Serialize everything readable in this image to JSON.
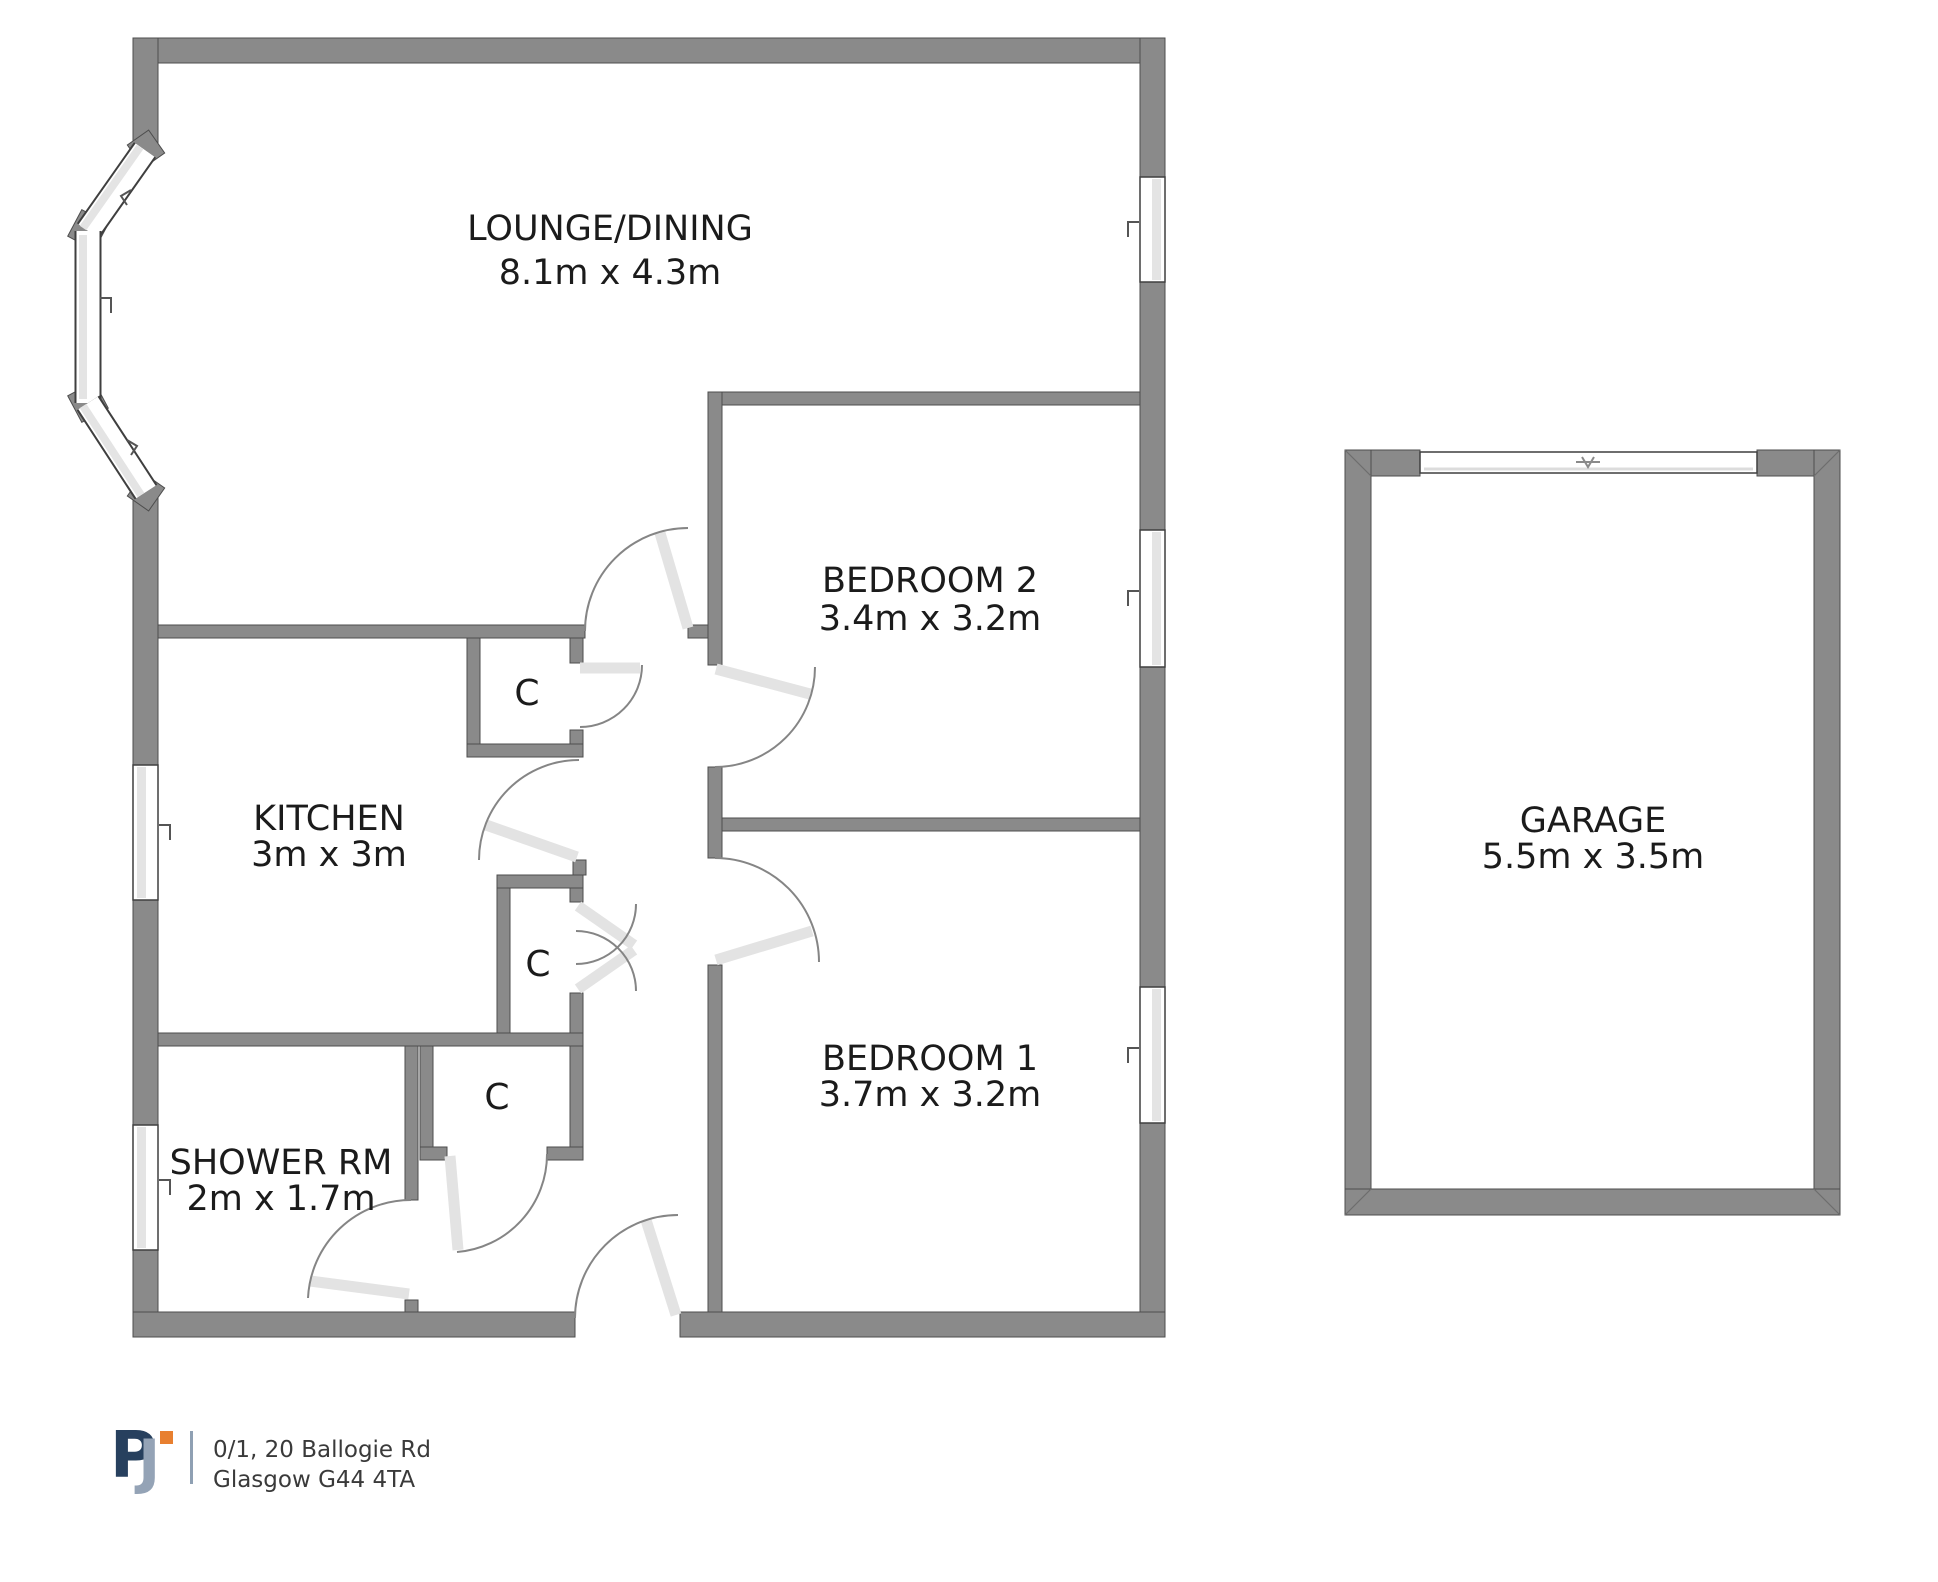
{
  "plan": {
    "rooms": [
      {
        "id": "lounge",
        "name": "LOUNGE/DINING",
        "dims": "8.1m x 4.3m"
      },
      {
        "id": "bedroom2",
        "name": "BEDROOM 2",
        "dims": "3.4m x 3.2m"
      },
      {
        "id": "kitchen",
        "name": "KITCHEN",
        "dims": "3m x 3m"
      },
      {
        "id": "bedroom1",
        "name": "BEDROOM 1",
        "dims": "3.7m x 3.2m"
      },
      {
        "id": "shower",
        "name": "SHOWER RM",
        "dims": "2m x 1.7m"
      },
      {
        "id": "garage",
        "name": "GARAGE",
        "dims": "5.5m x 3.5m"
      }
    ],
    "closet_label": "C"
  },
  "footer": {
    "logo": {
      "p": "P",
      "j": "J"
    },
    "address_line1": "0/1, 20 Ballogie Rd",
    "address_line2": "Glasgow G44 4TA"
  },
  "colors": {
    "wall": "#8a8a8a",
    "window_pane": "#e4e4e4",
    "logo_navy": "#27405e",
    "logo_blue_gray": "#94a3b6",
    "logo_orange": "#e87f2f"
  }
}
